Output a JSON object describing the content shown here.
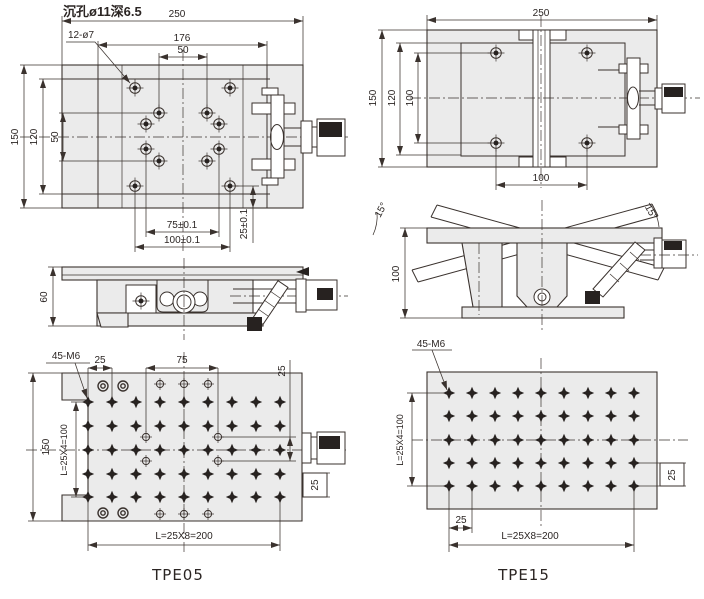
{
  "colors": {
    "line": "#3a322e",
    "plate": "#ebebeb",
    "dark": "#272220",
    "text": "#2b2523"
  },
  "note": {
    "counterbore": "沉孔ø11深6.5"
  },
  "tpe05": {
    "label": "TPE05",
    "top_view": {
      "width_total": "250",
      "hole_callout": "12-ø7",
      "width_176": "176",
      "width_50": "50",
      "height_150": "150",
      "height_120": "120",
      "height_50": "50",
      "dim_75": "75±0.1",
      "dim_100": "100±0.1",
      "dim_25": "25±0.1"
    },
    "side_view": {
      "height_60": "60"
    },
    "bottom_view": {
      "thread_callout": "45-M6",
      "pitch_25_top": "25",
      "dim_75": "75",
      "dim_25_mid": "25",
      "height_150": "150",
      "len_vert": "L=25X4=100",
      "dim_25_right": "25",
      "len_horiz": "L=25X8=200"
    }
  },
  "tpe15": {
    "label": "TPE15",
    "top_view": {
      "width_total": "250",
      "height_150": "150",
      "height_120": "120",
      "height_100": "100",
      "width_100": "100"
    },
    "side_view": {
      "angle_left": "15°",
      "angle_right": "15°",
      "height_100": "100"
    },
    "bottom_view": {
      "thread_callout": "45-M6",
      "len_vert": "L=25X4=100",
      "dim_25_right": "25",
      "pitch_25_bottom": "25",
      "len_horiz": "L=25X8=200"
    }
  }
}
